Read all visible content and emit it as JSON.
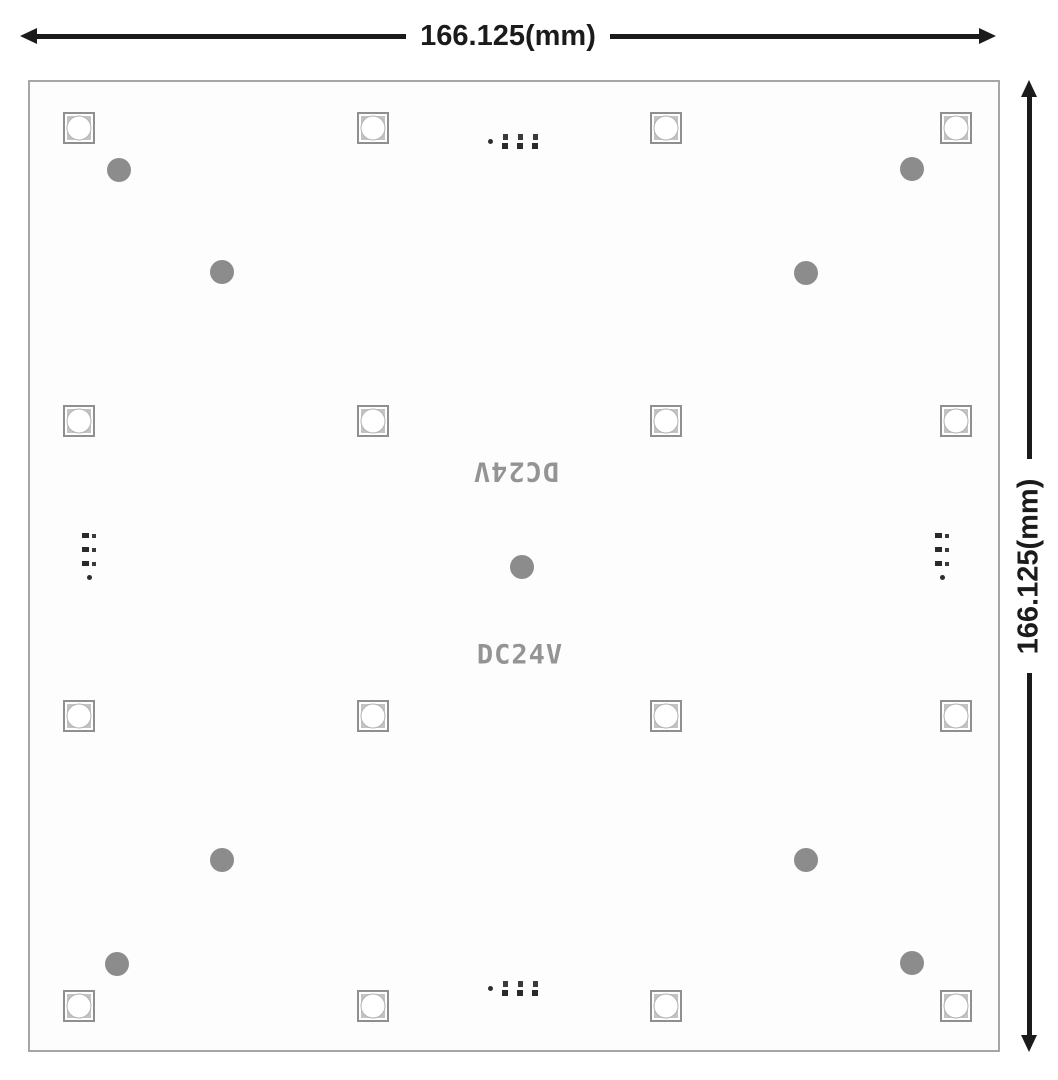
{
  "dimension_annotations": {
    "horizontal": {
      "label": "166.125(mm)"
    },
    "vertical": {
      "label": "166.125(mm)"
    }
  },
  "board": {
    "silkscreen_label_rotated": "DC24V",
    "silkscreen_label": "DC24V",
    "border_color": "#a6a6a6",
    "fill_color": "#fdfdfd"
  },
  "led_grid": {
    "rows": 4,
    "cols": 4,
    "count": 16,
    "size_px": 32,
    "centers_x_px": [
      49,
      343,
      636,
      926
    ],
    "centers_y_px": [
      46,
      339,
      634,
      924
    ],
    "body_color": "#c3c3c3",
    "border_color": "#8f8f8f",
    "lens_color": "#ffffff"
  },
  "mounting_holes": {
    "count": 9,
    "radius_px": 12,
    "color": "#8c8c8c",
    "centers_px": [
      [
        89,
        88
      ],
      [
        882,
        87
      ],
      [
        192,
        190
      ],
      [
        776,
        191
      ],
      [
        492,
        485
      ],
      [
        192,
        778
      ],
      [
        776,
        778
      ],
      [
        87,
        882
      ],
      [
        882,
        881
      ]
    ]
  },
  "connectors": {
    "count": 4,
    "pads_per_connector": 3,
    "pad_color": "#2f2f2f",
    "positions": [
      "top-center",
      "bottom-center",
      "middle-left",
      "middle-right"
    ]
  },
  "colors": {
    "arrow": "#1b1b1b",
    "silkscreen_text": "#949494"
  }
}
